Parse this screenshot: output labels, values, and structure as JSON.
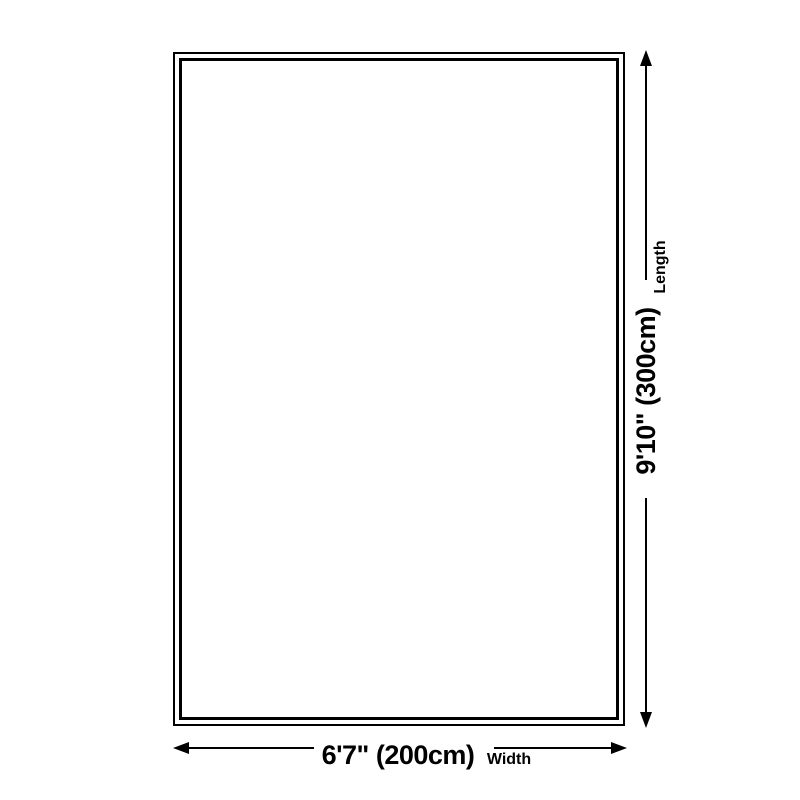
{
  "diagram": {
    "type": "size-dimension-diagram",
    "dimensions": {
      "width": {
        "value": "6'7\" (200cm)",
        "label": "Width"
      },
      "length": {
        "value": "9'10\" (300cm)",
        "label": "Length"
      }
    },
    "colors": {
      "line": "#000000",
      "background": "#ffffff"
    }
  }
}
